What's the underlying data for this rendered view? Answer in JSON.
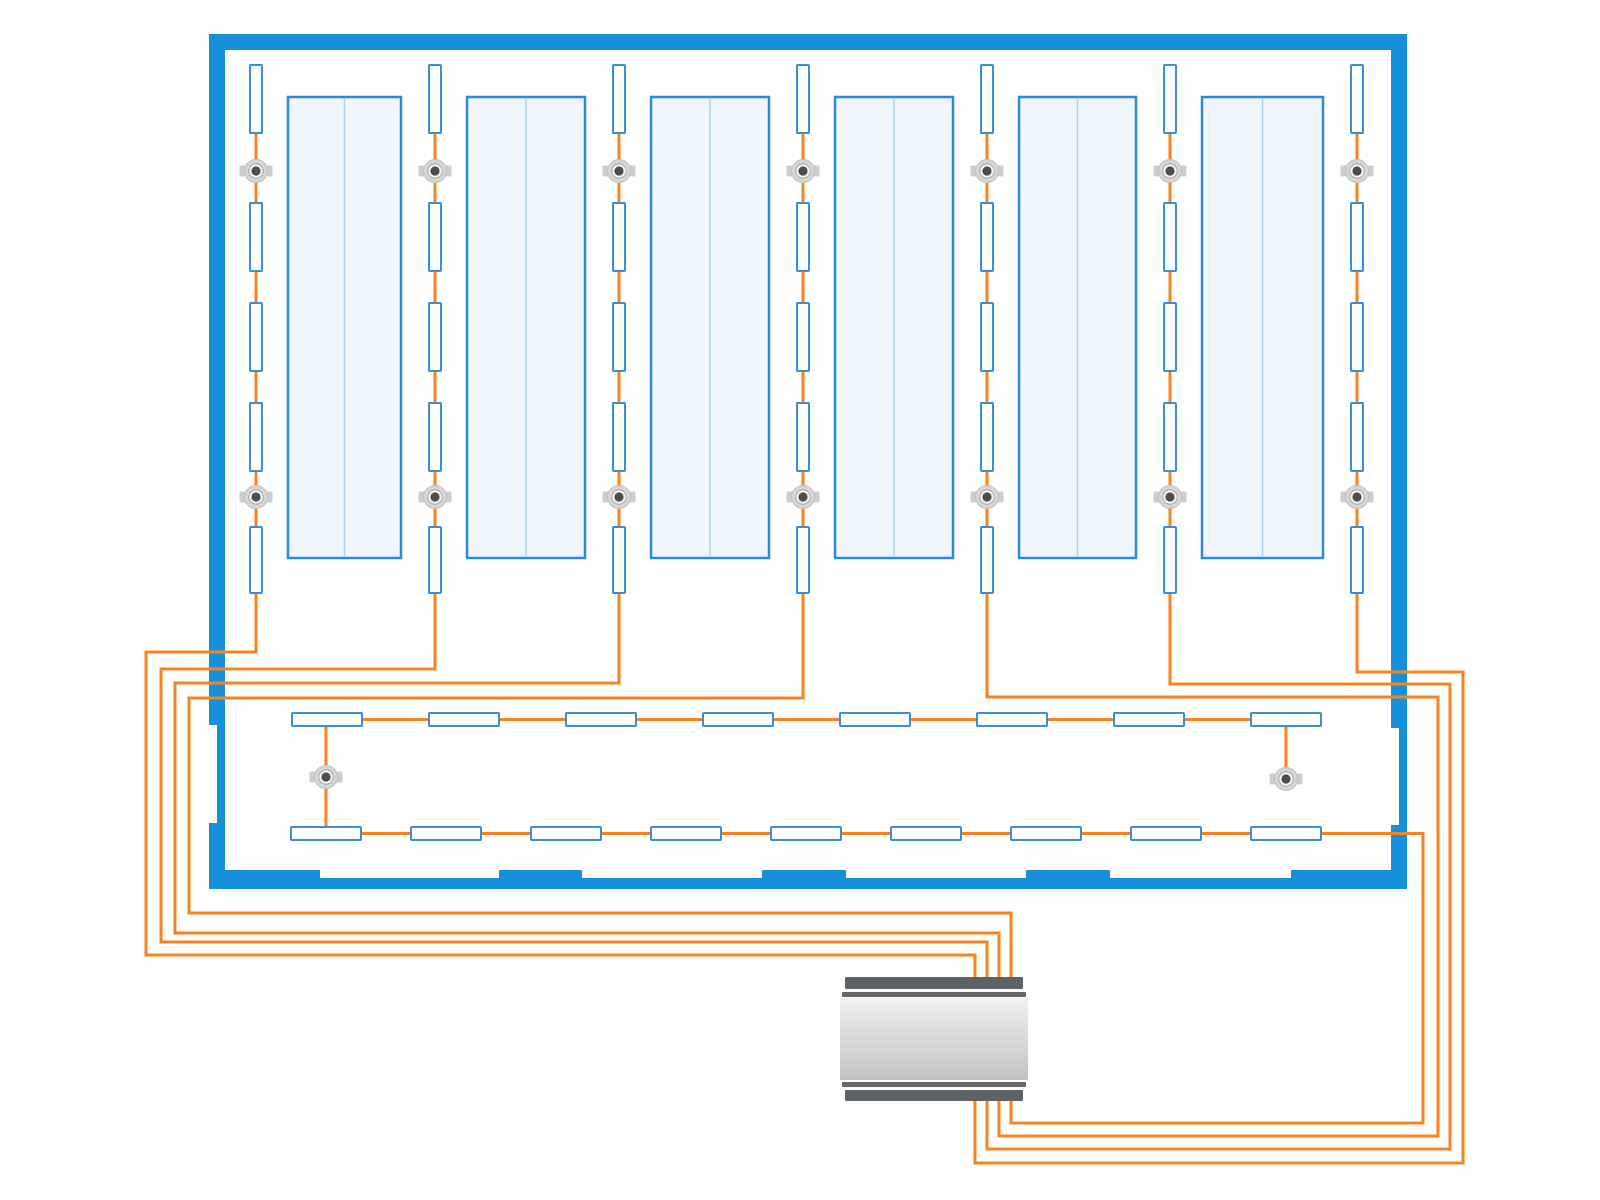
{
  "canvas": {
    "width": 1600,
    "height": 1200,
    "background": "#ffffff"
  },
  "colors": {
    "wall": "#1690da",
    "wire": "#f5831f",
    "fixture_stroke": "#3a8ed8",
    "fixture_fill": "#fdfeff",
    "table_fill": "#eff7fc",
    "table_stroke": "#2f88d8",
    "table_divider": "#aed2ec",
    "node_ring": "#d6d6d6",
    "node_rim": "#c0c0c0",
    "node_inner": "#f4f4f4",
    "node_inner_rim": "#9c9c9c",
    "node_core": "#4e4e4e",
    "node_tab": "#cdcdcd",
    "controller_cap": "#5f6265",
    "controller_ring": "#63666a",
    "controller_body_light": "#f1f1f1",
    "controller_body_mid": "#dcdcdc",
    "controller_body_dark": "#c2c2c2"
  },
  "building": {
    "walls": [
      {
        "id": "wall-top",
        "x": 209,
        "y": 34,
        "w": 1198,
        "h": 16
      },
      {
        "id": "wall-left",
        "x": 209,
        "y": 34,
        "w": 16,
        "h": 855
      },
      {
        "id": "wall-right",
        "x": 1391,
        "y": 34,
        "w": 16,
        "h": 855
      },
      {
        "id": "wall-bottom",
        "x": 209,
        "y": 870,
        "w": 1198,
        "h": 19
      }
    ],
    "door_notches": [
      {
        "id": "door-left",
        "x": 209,
        "y": 725,
        "w": 8,
        "h": 98
      },
      {
        "id": "door-right",
        "x": 1391,
        "y": 728,
        "w": 8,
        "h": 97
      },
      {
        "id": "door-bottom-1",
        "x": 320,
        "y": 870,
        "w": 179,
        "h": 8
      },
      {
        "id": "door-bottom-2",
        "x": 582,
        "y": 870,
        "w": 180,
        "h": 8
      },
      {
        "id": "door-bottom-3",
        "x": 846,
        "y": 870,
        "w": 180,
        "h": 8
      },
      {
        "id": "door-bottom-4",
        "x": 1110,
        "y": 870,
        "w": 181,
        "h": 8
      }
    ]
  },
  "tables": {
    "y": 97,
    "h": 461,
    "items": [
      {
        "x": 288,
        "w": 113
      },
      {
        "x": 467,
        "w": 118
      },
      {
        "x": 651,
        "w": 118
      },
      {
        "x": 835,
        "w": 118
      },
      {
        "x": 1019,
        "w": 117
      },
      {
        "x": 1202,
        "w": 121
      }
    ]
  },
  "chains": {
    "count": 7,
    "xs": [
      256,
      435,
      619,
      803,
      987,
      1170,
      1357
    ],
    "fixture": {
      "w": 12,
      "slots": [
        {
          "y": 65,
          "h": 68
        },
        {
          "y": 203,
          "h": 68
        },
        {
          "y": 303,
          "h": 68
        },
        {
          "y": 403,
          "h": 68
        },
        {
          "y": 527,
          "h": 66
        }
      ]
    },
    "node_ys": [
      171,
      497
    ],
    "routes": [
      "M256 92 V652 H146 V955 H975 V978",
      "M435 92 V669 H161 V942 H987 V978",
      "M619 92 V683 H175 V933 H999 V978",
      "M803 92 V698 H189 V913 H1011 V978",
      "M987 92 V697 H1438 V1136 H999 V1100",
      "M1170 92 V684 H1450 V1149 H987 V1100",
      "M1357 92 V672 H1463 V1163 H975 V1100"
    ]
  },
  "rows": {
    "fixture": {
      "w": 70,
      "h": 13
    },
    "top": {
      "y": 713,
      "centers": [
        327,
        464,
        601,
        738,
        875,
        1012,
        1149,
        1286
      ],
      "wire_y": 719.5
    },
    "bottom": {
      "y": 827,
      "centers": [
        326,
        446,
        566,
        686,
        806,
        926,
        1046,
        1166,
        1286
      ],
      "wire_y": 833.5
    },
    "wires": [
      {
        "id": "wire-row-top",
        "d": "M327 719.5 H1286"
      },
      {
        "id": "wire-row-drop-left",
        "d": "M326 719.5 V833.5"
      },
      {
        "id": "wire-row-drop-right",
        "d": "M1286 719.5 V769"
      },
      {
        "id": "wire-row-bottom",
        "d": "M326 833.5 H1423 V1123 H1011 V1100"
      }
    ],
    "nodes": [
      {
        "x": 326,
        "y": 777
      },
      {
        "x": 1286,
        "y": 779
      }
    ]
  },
  "controller": {
    "parts": [
      {
        "id": "cap-top",
        "x": 845,
        "y": 977,
        "w": 178,
        "h": 12,
        "kind": "cap"
      },
      {
        "id": "ring-top",
        "x": 842,
        "y": 992,
        "w": 184,
        "h": 5,
        "kind": "ring"
      },
      {
        "id": "body",
        "x": 840,
        "y": 998,
        "w": 188,
        "h": 82,
        "kind": "body"
      },
      {
        "id": "ring-bottom",
        "x": 842,
        "y": 1082,
        "w": 184,
        "h": 5,
        "kind": "ring"
      },
      {
        "id": "cap-bottom",
        "x": 845,
        "y": 1090,
        "w": 178,
        "h": 11,
        "kind": "cap"
      }
    ]
  },
  "wire_width": 3,
  "counts": {
    "chains": 7,
    "chain_fixtures": 35,
    "row_fixtures_top": 8,
    "row_fixtures_bottom": 9,
    "nodes": 16,
    "tables": 6
  }
}
